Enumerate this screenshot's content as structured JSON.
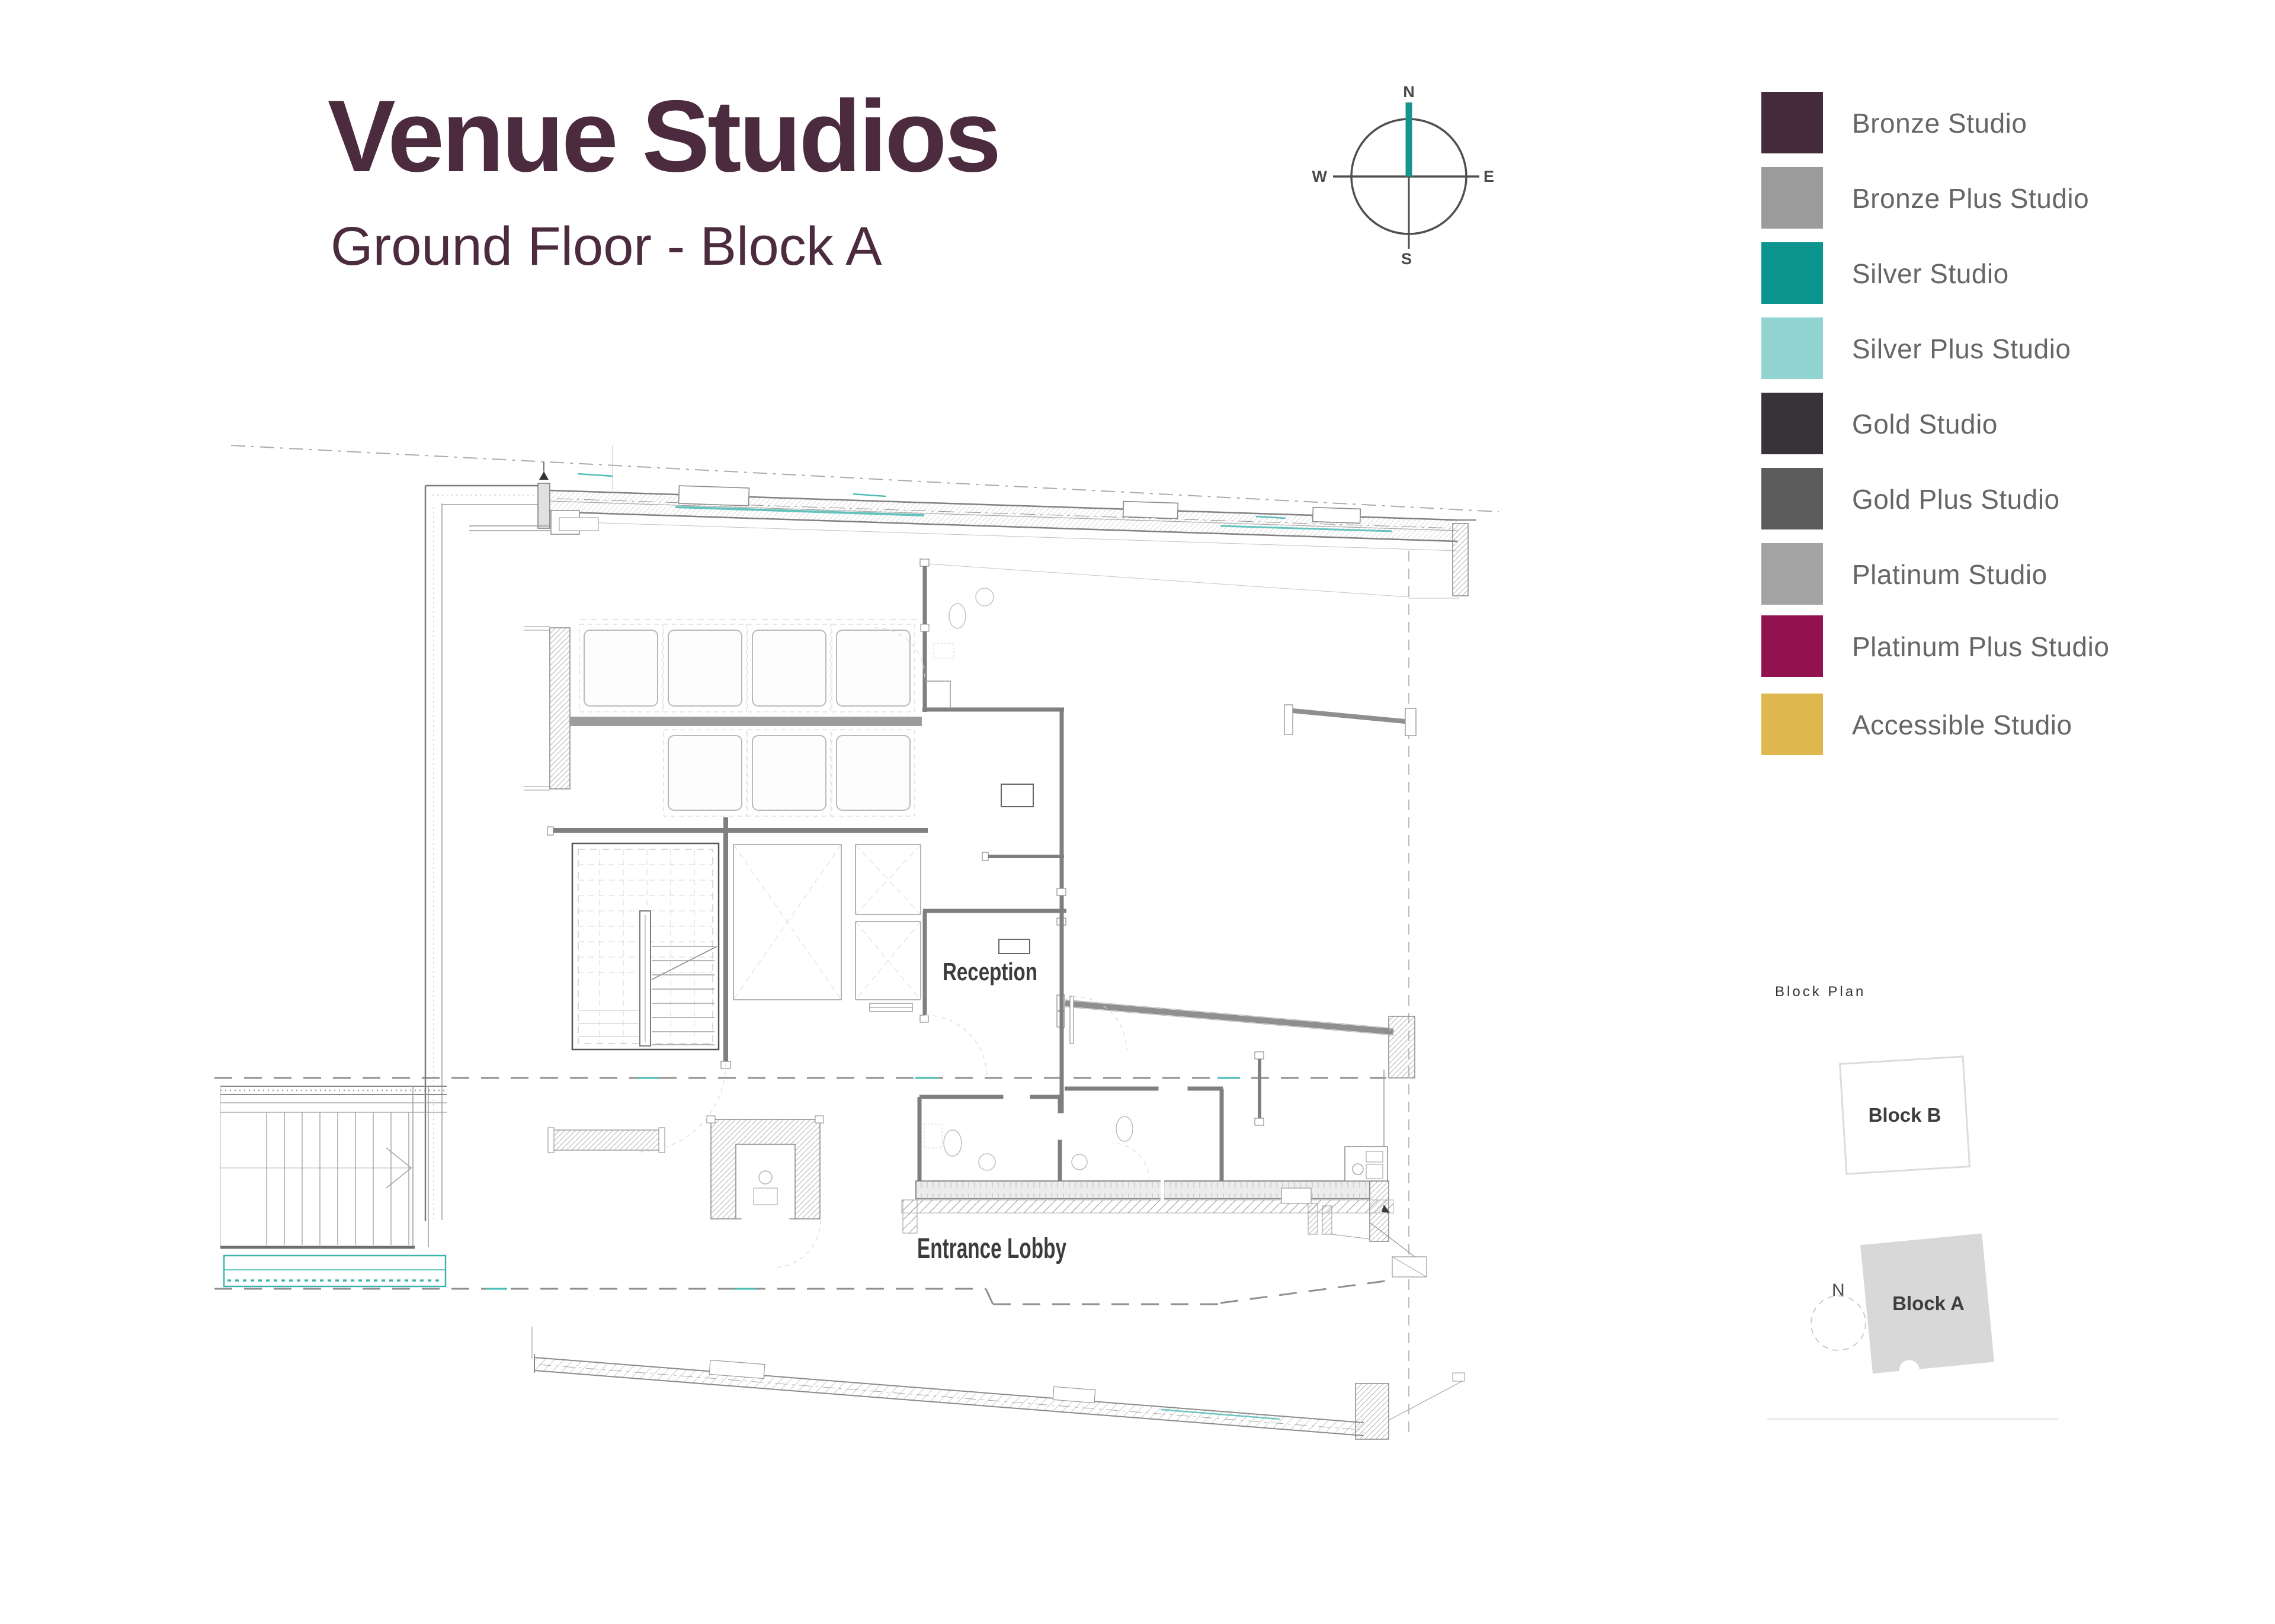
{
  "header": {
    "title": "Venue Studios",
    "subtitle": "Ground Floor - Block A"
  },
  "compass": {
    "north": "N",
    "south": "S",
    "east": "E",
    "west": "W"
  },
  "legend": {
    "items": [
      {
        "label": "Bronze Studio",
        "color": "#452A3A"
      },
      {
        "label": "Bronze Plus Studio",
        "color": "#9B9B9B"
      },
      {
        "label": "Silver Studio",
        "color": "#0A958E"
      },
      {
        "label": "Silver Plus Studio",
        "color": "#92D4D2"
      },
      {
        "label": "Gold Studio",
        "color": "#383338"
      },
      {
        "label": "Gold Plus Studio",
        "color": "#5C5C5C"
      },
      {
        "label": "Platinum Studio",
        "color": "#A3A3A3"
      },
      {
        "label": "Platinum Plus Studio",
        "color": "#92124F"
      },
      {
        "label": "Accessible Studio",
        "color": "#DEB84E"
      }
    ]
  },
  "floor_plan": {
    "rooms": {
      "reception": "Reception",
      "entrance_lobby": "Entrance Lobby"
    }
  },
  "block_plan": {
    "title": "Block Plan",
    "north_label": "N",
    "blocks": [
      {
        "label": "Block B"
      },
      {
        "label": "Block A"
      }
    ]
  },
  "palette": {
    "title_color": "#4B2B3D",
    "accent_teal": "#17948C",
    "wall_gray": "#7F7F7F",
    "label_gray": "#666666"
  }
}
